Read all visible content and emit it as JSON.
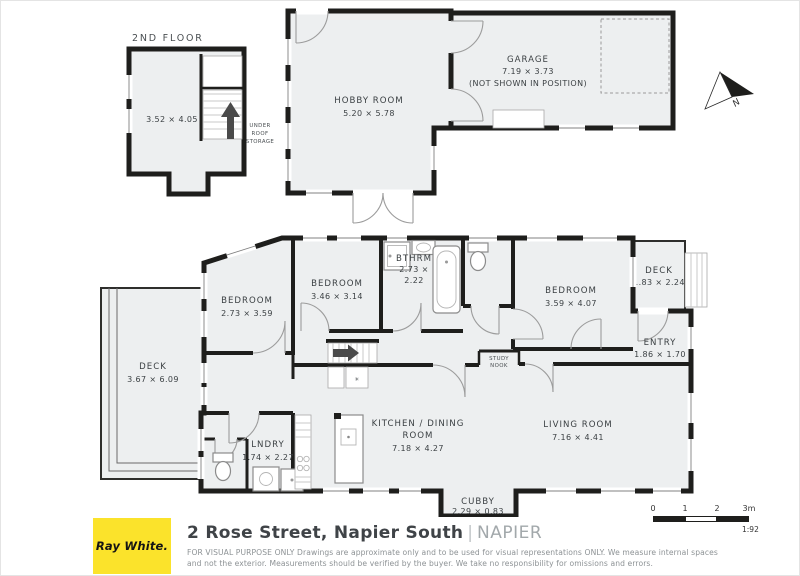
{
  "second_floor": {
    "label": "2ND FLOOR",
    "dim": "3.52 × 4.05",
    "storage_l1": "UNDER",
    "storage_l2": "ROOF",
    "storage_l3": "STORAGE"
  },
  "rooms": {
    "hobby": {
      "name": "HOBBY ROOM",
      "dim": "5.20 × 5.78"
    },
    "garage": {
      "name": "GARAGE",
      "dim": "7.19 × 3.73",
      "note": "(NOT SHOWN IN POSITION)"
    },
    "bedroom_left": {
      "name": "BEDROOM",
      "dim": "2.73 × 3.59"
    },
    "bedroom_mid": {
      "name": "BEDROOM",
      "dim": "3.46 × 3.14"
    },
    "bathroom": {
      "name": "BTHRM",
      "dim1": "2.73 ×",
      "dim2": "2.22"
    },
    "bedroom_right": {
      "name": "BEDROOM",
      "dim": "3.59 × 4.07"
    },
    "deck_right": {
      "name": "DECK",
      "dim": "1.83 × 2.24"
    },
    "entry": {
      "name": "ENTRY",
      "dim": "1.86 × 1.70"
    },
    "deck_left": {
      "name": "DECK",
      "dim": "3.67 × 6.09"
    },
    "kitchen": {
      "name1": "KITCHEN / DINING",
      "name2": "ROOM",
      "dim": "7.18 × 4.27"
    },
    "living": {
      "name": "LIVING ROOM",
      "dim": "7.16 × 4.41"
    },
    "laundry": {
      "name": "LNDRY",
      "dim": "1.74 × 2.27"
    },
    "cubby": {
      "name": "CUBBY",
      "dim": "2.29 × 0.83"
    },
    "study_nook": {
      "l1": "STUDY",
      "l2": "NOOK"
    }
  },
  "icons": {
    "heater": "✳"
  },
  "compass": {
    "label": "N"
  },
  "footer": {
    "brand": "Ray White.",
    "address": "2 Rose Street, Napier South",
    "separator": "|",
    "suburb": "NAPIER",
    "disclaimer1": "FOR VISUAL PURPOSE ONLY Drawings are approximate only and to be used for visual representations ONLY. We measure internal spaces",
    "disclaimer2": "and not the exterior. Measurements should be verified by the buyer. We take no responsibility for omissions and errors.",
    "scale": {
      "t0": "0",
      "t1": "1",
      "t2": "2",
      "t3": "3m",
      "ratio": "1:92"
    }
  },
  "colors": {
    "wall": "#1e1e1c",
    "room_fill": "#edeff0",
    "brand_yellow": "#fbe32b",
    "door_arc": "#9c9c9c"
  }
}
